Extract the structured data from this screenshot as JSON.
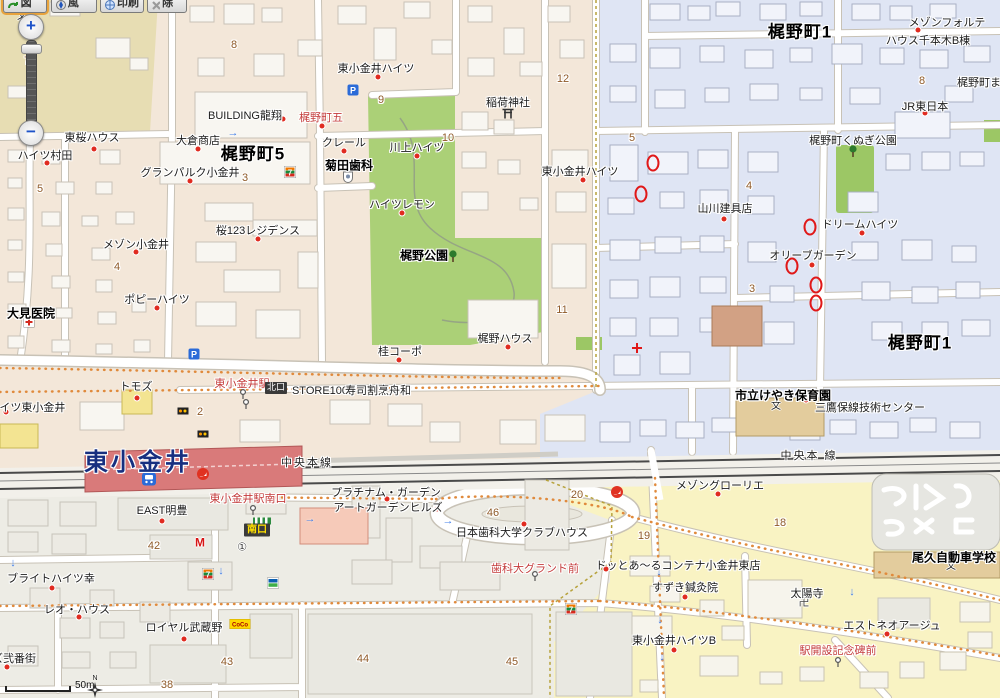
{
  "toolbar": {
    "buttons": [
      {
        "id": "map-button",
        "label": "地図"
      },
      {
        "id": "threed-button",
        "label": "3D風"
      },
      {
        "id": "print-button",
        "label": "印刷"
      },
      {
        "id": "clear-button",
        "label": "解除"
      }
    ]
  },
  "zoom_control": {
    "zoom_in": "+",
    "zoom_out": "−"
  },
  "scale_bar": {
    "label": "50m"
  },
  "compass": {
    "label": "N"
  },
  "map": {
    "labels": [
      {
        "id": "area-kajinocho-5",
        "t": "梶野町5",
        "x": 253,
        "y": 155,
        "c": "area"
      },
      {
        "id": "area-kajinocho-1-north",
        "t": "梶野町1",
        "x": 800,
        "y": 33,
        "c": "area"
      },
      {
        "id": "area-kajinocho-1-east",
        "t": "梶野町1",
        "x": 920,
        "y": 344,
        "c": "area"
      },
      {
        "id": "station-name",
        "t": "東小金井",
        "x": 138,
        "y": 463,
        "c": "st"
      },
      {
        "id": "chuo-line-west",
        "t": "中央本線",
        "x": 307,
        "y": 463,
        "c": "rail"
      },
      {
        "id": "chuo-line-east",
        "t": "中央本 線",
        "x": 809,
        "y": 456,
        "c": "rail"
      },
      {
        "id": "kajino-park",
        "t": "梶野公園",
        "x": 424,
        "y": 256,
        "c": "b"
      },
      {
        "id": "omi-clinic",
        "t": "大見医院",
        "x": 31,
        "y": 314,
        "c": "b"
      },
      {
        "id": "kikuta-dental",
        "t": "菊田歯科",
        "x": 349,
        "y": 166,
        "c": "b"
      },
      {
        "id": "keyaki-nursery",
        "t": "市立けやき保育園",
        "x": 783,
        "y": 396,
        "c": "b"
      },
      {
        "id": "ogu-driving-school",
        "t": "尾久自動車学校",
        "x": 954,
        "y": 558,
        "c": "b"
      },
      {
        "id": "stop-kajinocho-go",
        "t": "梶野町五",
        "x": 321,
        "y": 118,
        "c": "r"
      },
      {
        "id": "stop-higashi-koganei-sta",
        "t": "東小金井駅",
        "x": 242,
        "y": 384,
        "c": "r"
      },
      {
        "id": "stop-south-exit",
        "t": "東小金井駅南口",
        "x": 248,
        "y": 499,
        "c": "r"
      },
      {
        "id": "stop-shikadai-ground",
        "t": "歯科大グランド前",
        "x": 535,
        "y": 569,
        "c": "r"
      },
      {
        "id": "stop-ekikaisetsu-kinenhi",
        "t": "駅開設記念碑前",
        "x": 838,
        "y": 651,
        "c": "r"
      },
      {
        "id": "north-exit-badge",
        "t": "北口",
        "x": 276,
        "y": 388,
        "c": "badge-n"
      },
      {
        "id": "south-exit-badge",
        "t": "南口",
        "x": 257,
        "y": 530,
        "c": "badge-s"
      },
      {
        "id": "building-ryusho",
        "t": "BUILDING龍翔",
        "x": 245,
        "y": 116
      },
      {
        "id": "higashi-koganei-heights-north",
        "t": "東小金井ハイツ",
        "x": 376,
        "y": 69
      },
      {
        "id": "higashi-koganei-heights-east",
        "t": "東小金井ハイツ",
        "x": 580,
        "y": 172
      },
      {
        "id": "claire",
        "t": "クレール",
        "x": 344,
        "y": 143
      },
      {
        "id": "kawakami-heights",
        "t": "川上ハイツ",
        "x": 417,
        "y": 148
      },
      {
        "id": "okura-shoten",
        "t": "大倉商店",
        "x": 198,
        "y": 141
      },
      {
        "id": "tozakura-house",
        "t": "東桜ハウス",
        "x": 92,
        "y": 138
      },
      {
        "id": "heights-murata",
        "t": "ハイツ村田",
        "x": 45,
        "y": 156
      },
      {
        "id": "grand-parc-koganei",
        "t": "グランパルク小金井",
        "x": 190,
        "y": 173
      },
      {
        "id": "sakura123-residence",
        "t": "桜123レジデンス",
        "x": 258,
        "y": 231
      },
      {
        "id": "maison-koganei",
        "t": "メゾン小金井",
        "x": 136,
        "y": 245
      },
      {
        "id": "poppy-heights",
        "t": "ポピーハイツ",
        "x": 157,
        "y": 300
      },
      {
        "id": "heights-lemon",
        "t": "ハイツレモン",
        "x": 402,
        "y": 205
      },
      {
        "id": "inari-shrine",
        "t": "稲荷神社",
        "x": 508,
        "y": 103
      },
      {
        "id": "kajino-house",
        "t": "梶野ハウス",
        "x": 505,
        "y": 339
      },
      {
        "id": "katsura-corpo",
        "t": "桂コーポ",
        "x": 400,
        "y": 352
      },
      {
        "id": "store100",
        "t": "STORE100",
        "x": 320,
        "y": 391
      },
      {
        "id": "sushi-funawa",
        "t": "寿司割烹舟和",
        "x": 378,
        "y": 391
      },
      {
        "id": "tomods",
        "t": "トモズ",
        "x": 136,
        "y": 387
      },
      {
        "id": "heights-higashi-koganei",
        "t": "ハイツ東小金井",
        "x": 27,
        "y": 408
      },
      {
        "id": "yamakawa-tategu",
        "t": "山川建具店",
        "x": 725,
        "y": 209
      },
      {
        "id": "dream-heights",
        "t": "ドリームハイツ",
        "x": 860,
        "y": 225
      },
      {
        "id": "olive-garden",
        "t": "オリーブガーデン",
        "x": 813,
        "y": 256
      },
      {
        "id": "maison-forte",
        "t": "メゾンフォルテ",
        "x": 947,
        "y": 23
      },
      {
        "id": "house-senbongi-b",
        "t": "ハウス千本木B棟",
        "x": 928,
        "y": 41
      },
      {
        "id": "jr-east",
        "t": "JR東日本",
        "x": 925,
        "y": 107
      },
      {
        "id": "kunugi-park",
        "t": "梶野町くぬぎ公園",
        "x": 853,
        "y": 141
      },
      {
        "id": "kajinocho-ma",
        "t": "梶野町ま",
        "x": 979,
        "y": 83
      },
      {
        "id": "mitaka-hosen-center",
        "t": "三鷹保線技術センター",
        "x": 870,
        "y": 408
      },
      {
        "id": "maison-glorie",
        "t": "メゾングローリエ",
        "x": 720,
        "y": 486
      },
      {
        "id": "platinum-garden",
        "t": "プラチナム・ガーデン",
        "x": 386,
        "y": 493
      },
      {
        "id": "art-garden-hills",
        "t": "アートガーデンヒルズ",
        "x": 388,
        "y": 508
      },
      {
        "id": "nihon-shika-clubhouse",
        "t": "日本歯科大学クラブハウス",
        "x": 522,
        "y": 533
      },
      {
        "id": "dot-ar-container",
        "t": "ドッとあ〜るコンテナ小金井東店",
        "x": 678,
        "y": 566
      },
      {
        "id": "suzuki-shinkyuin",
        "t": "すずき鍼灸院",
        "x": 685,
        "y": 588
      },
      {
        "id": "taiyoji-temple",
        "t": "太陽寺",
        "x": 807,
        "y": 594
      },
      {
        "id": "est-neo-age",
        "t": "エストネオアージュ",
        "x": 892,
        "y": 626
      },
      {
        "id": "higashi-koganei-heights-b",
        "t": "東小金井ハイツB",
        "x": 674,
        "y": 641
      },
      {
        "id": "east-meiho",
        "t": "EAST明豊",
        "x": 162,
        "y": 511
      },
      {
        "id": "bright-heights-sachi",
        "t": "ブライトハイツ幸",
        "x": 51,
        "y": 579
      },
      {
        "id": "leo-house",
        "t": "レオ・ハウス",
        "x": 77,
        "y": 610
      },
      {
        "id": "royal-musashino",
        "t": "ロイヤル武蔵野",
        "x": 184,
        "y": 628
      },
      {
        "id": "zu-nibangai",
        "t": "ズ弐番街",
        "x": 14,
        "y": 659
      },
      {
        "id": "block-number",
        "t": "7",
        "x": 27,
        "y": 61,
        "c": "n"
      },
      {
        "id": "block-number",
        "t": "8",
        "x": 234,
        "y": 45,
        "c": "n"
      },
      {
        "id": "block-number",
        "t": "9",
        "x": 381,
        "y": 100,
        "c": "n"
      },
      {
        "id": "block-number",
        "t": "10",
        "x": 448,
        "y": 138,
        "c": "n"
      },
      {
        "id": "block-number",
        "t": "12",
        "x": 563,
        "y": 79,
        "c": "n"
      },
      {
        "id": "block-number",
        "t": "5",
        "x": 40,
        "y": 189,
        "c": "n"
      },
      {
        "id": "block-number",
        "t": "3",
        "x": 245,
        "y": 178,
        "c": "n"
      },
      {
        "id": "block-number",
        "t": "4",
        "x": 117,
        "y": 267,
        "c": "n"
      },
      {
        "id": "block-number",
        "t": "11",
        "x": 562,
        "y": 310,
        "c": "n"
      },
      {
        "id": "block-number",
        "t": "5",
        "x": 632,
        "y": 138,
        "c": "n"
      },
      {
        "id": "block-number",
        "t": "4",
        "x": 749,
        "y": 186,
        "c": "n"
      },
      {
        "id": "block-number",
        "t": "3",
        "x": 752,
        "y": 289,
        "c": "n"
      },
      {
        "id": "block-number",
        "t": "8",
        "x": 922,
        "y": 81,
        "c": "n"
      },
      {
        "id": "block-number",
        "t": "2",
        "x": 200,
        "y": 412,
        "c": "n"
      },
      {
        "id": "block-number",
        "t": "42",
        "x": 154,
        "y": 546,
        "c": "n"
      },
      {
        "id": "block-number",
        "t": "46",
        "x": 493,
        "y": 513,
        "c": "n"
      },
      {
        "id": "block-number",
        "t": "20",
        "x": 577,
        "y": 495,
        "c": "n"
      },
      {
        "id": "block-number",
        "t": "19",
        "x": 644,
        "y": 536,
        "c": "n"
      },
      {
        "id": "block-number",
        "t": "18",
        "x": 780,
        "y": 523,
        "c": "n"
      },
      {
        "id": "block-number",
        "t": "44",
        "x": 363,
        "y": 659,
        "c": "n"
      },
      {
        "id": "block-number",
        "t": "45",
        "x": 512,
        "y": 662,
        "c": "n"
      },
      {
        "id": "block-number",
        "t": "43",
        "x": 227,
        "y": 662,
        "c": "n"
      },
      {
        "id": "block-number",
        "t": "38",
        "x": 167,
        "y": 685,
        "c": "n"
      }
    ],
    "icons": [
      {
        "t": "school",
        "x": 22,
        "y": 17
      },
      {
        "t": "school",
        "x": 776,
        "y": 407
      },
      {
        "t": "school",
        "x": 951,
        "y": 567
      },
      {
        "t": "torii",
        "x": 508,
        "y": 113
      },
      {
        "t": "tree",
        "x": 453,
        "y": 256
      },
      {
        "t": "tree",
        "x": 853,
        "y": 151
      },
      {
        "t": "seven-eleven",
        "x": 290,
        "y": 172
      },
      {
        "t": "seven-eleven",
        "x": 208,
        "y": 574
      },
      {
        "t": "seven-eleven",
        "x": 571,
        "y": 609
      },
      {
        "t": "parking",
        "x": 353,
        "y": 90
      },
      {
        "t": "parking",
        "x": 194,
        "y": 354
      },
      {
        "t": "train-station",
        "x": 149,
        "y": 479
      },
      {
        "t": "jr-mark",
        "x": 203,
        "y": 474
      },
      {
        "t": "jr-mark",
        "x": 617,
        "y": 492
      },
      {
        "t": "bus-stop",
        "x": 243,
        "y": 394
      },
      {
        "t": "bus-stop",
        "x": 246,
        "y": 404
      },
      {
        "t": "bus-stop",
        "x": 253,
        "y": 510
      },
      {
        "t": "bus-stop",
        "x": 535,
        "y": 576
      },
      {
        "t": "bus-stop",
        "x": 838,
        "y": 662
      },
      {
        "t": "sign",
        "x": 183,
        "y": 411
      },
      {
        "t": "sign",
        "x": 203,
        "y": 434
      },
      {
        "t": "circle-1",
        "x": 242,
        "y": 548
      },
      {
        "t": "manji",
        "x": 804,
        "y": 603
      },
      {
        "t": "mos",
        "x": 200,
        "y": 543
      },
      {
        "t": "coco",
        "x": 240,
        "y": 624
      },
      {
        "t": "familymart",
        "x": 273,
        "y": 583
      },
      {
        "t": "red-cross",
        "x": 637,
        "y": 348
      },
      {
        "t": "clinic",
        "x": 29,
        "y": 322
      },
      {
        "t": "dental",
        "x": 348,
        "y": 177
      },
      {
        "t": "crossing",
        "x": 262,
        "y": 521
      }
    ],
    "dots": [
      [
        283,
        119
      ],
      [
        378,
        77
      ],
      [
        322,
        126
      ],
      [
        344,
        151
      ],
      [
        417,
        156
      ],
      [
        198,
        149
      ],
      [
        94,
        149
      ],
      [
        47,
        163
      ],
      [
        190,
        181
      ],
      [
        258,
        239
      ],
      [
        136,
        252
      ],
      [
        157,
        308
      ],
      [
        402,
        213
      ],
      [
        583,
        180
      ],
      [
        508,
        347
      ],
      [
        399,
        360
      ],
      [
        137,
        398
      ],
      [
        6,
        412
      ],
      [
        724,
        219
      ],
      [
        862,
        233
      ],
      [
        812,
        265
      ],
      [
        918,
        30
      ],
      [
        925,
        113
      ],
      [
        806,
        400
      ],
      [
        718,
        494
      ],
      [
        387,
        499
      ],
      [
        437,
        509
      ],
      [
        524,
        524
      ],
      [
        606,
        569
      ],
      [
        685,
        597
      ],
      [
        887,
        634
      ],
      [
        674,
        650
      ],
      [
        162,
        521
      ],
      [
        52,
        588
      ],
      [
        79,
        617
      ],
      [
        184,
        639
      ],
      [
        7,
        667
      ]
    ],
    "ovals": [
      [
        653,
        163
      ],
      [
        641,
        194
      ],
      [
        810,
        227
      ],
      [
        792,
        266
      ],
      [
        816,
        285
      ],
      [
        816,
        303
      ]
    ],
    "arrows": [
      [
        233,
        133,
        "r"
      ],
      [
        310,
        519,
        "r"
      ],
      [
        448,
        521,
        "r"
      ],
      [
        13,
        563,
        "d"
      ],
      [
        221,
        571,
        "d"
      ],
      [
        659,
        572,
        "d"
      ],
      [
        660,
        620,
        "d"
      ],
      [
        662,
        657,
        "d"
      ],
      [
        852,
        592,
        "d"
      ]
    ]
  }
}
